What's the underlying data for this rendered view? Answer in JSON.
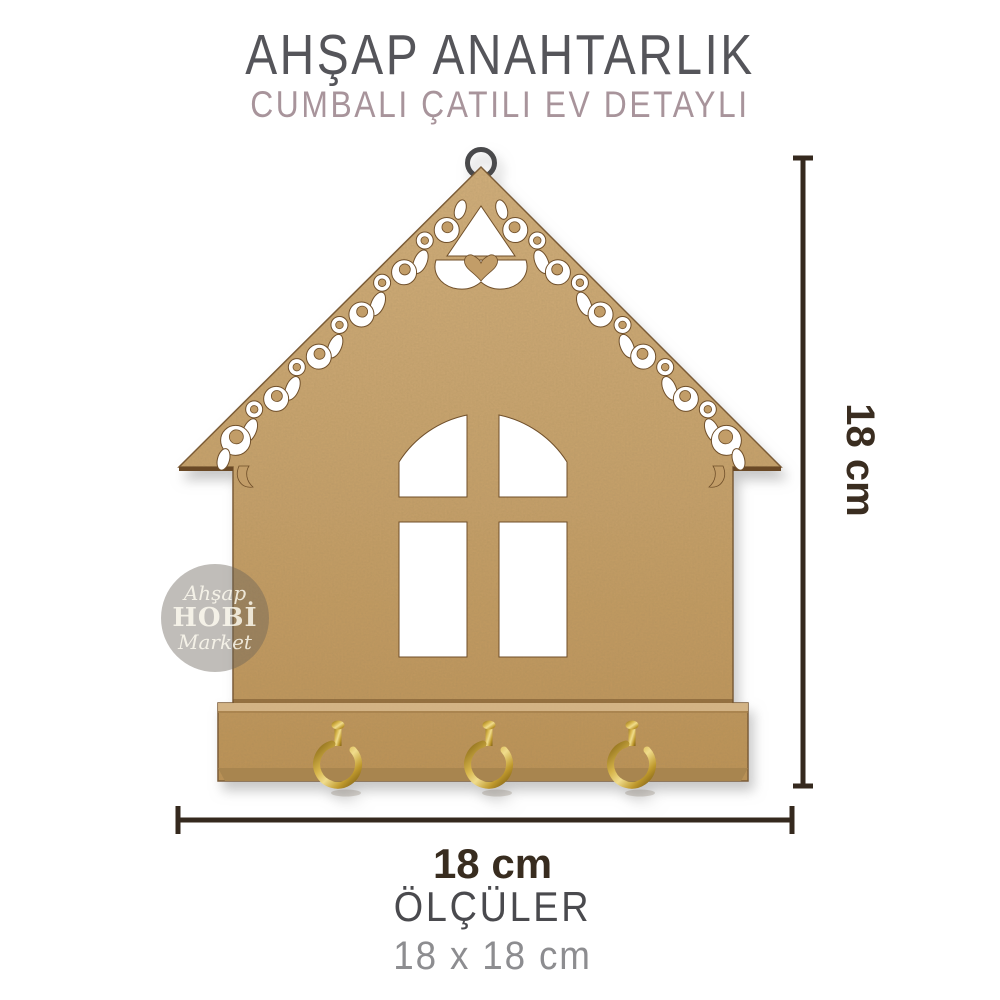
{
  "header": {
    "title": "AHŞAP ANAHTARLIK",
    "subtitle": "CUMBALI ÇATILI EV DETAYLI"
  },
  "dimensions": {
    "vertical_label": "18 cm",
    "horizontal_label": "18 cm"
  },
  "footer": {
    "heading": "ÖLÇÜLER",
    "size_text": "18 x 18 cm"
  },
  "watermark": {
    "line1": "Ahşap",
    "line2": "HOBİ",
    "line3": "Market"
  },
  "colors": {
    "title_text": "#55555a",
    "subtitle_text": "#a8949b",
    "wood": "#c4a06c",
    "wood_cut_edge": "#6f4f2a",
    "hook_gold": "#d7b54a",
    "hanging_ring": "#4a4a4c",
    "dimension_line": "#35291e",
    "footer_heading": "#4a4a4e",
    "footer_size": "#8d8d90",
    "watermark_badge": "rgba(104,97,87,0.42)"
  }
}
